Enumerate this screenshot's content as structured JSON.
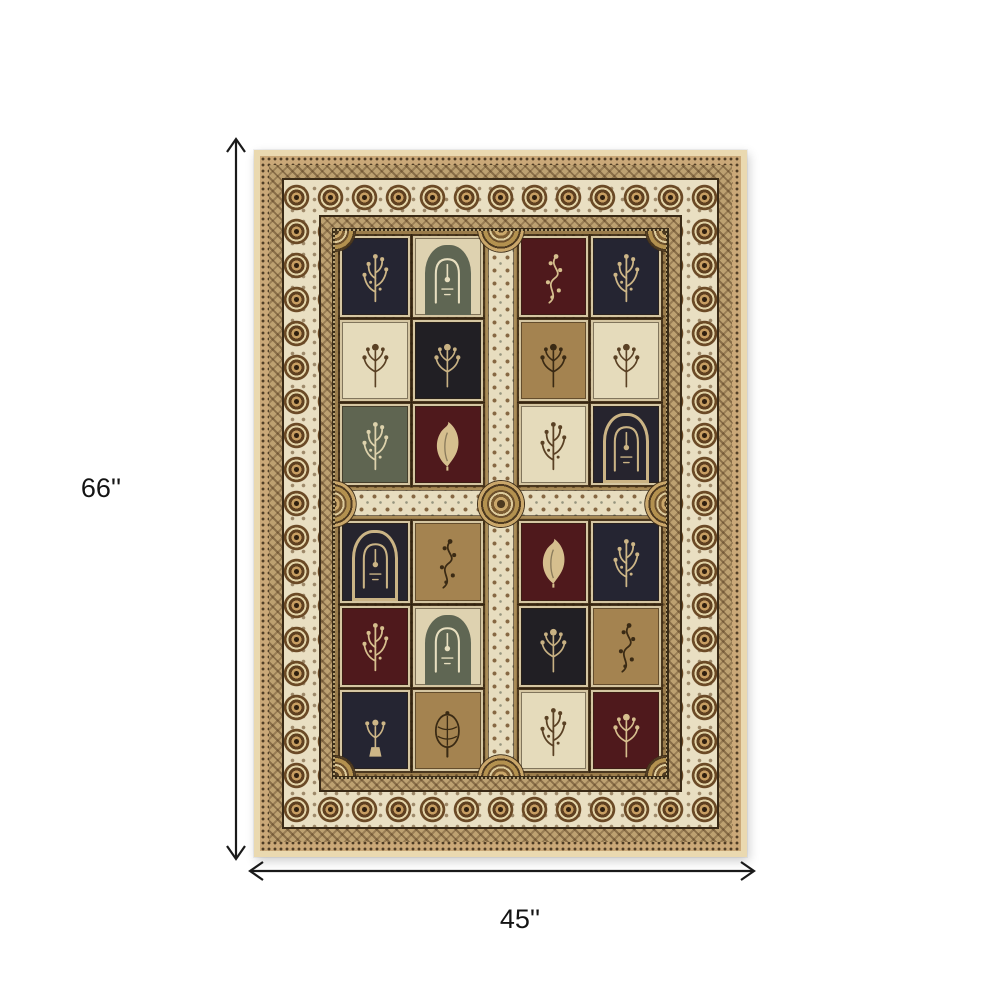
{
  "diagram": {
    "height_label": "66''",
    "width_label": "45''",
    "arrow_color": "#1a1a1a"
  },
  "rug": {
    "description": "Traditional ivory and brown panel-design area rug with garden-of-paradise motif panels and rosette border",
    "structure": {
      "binding": "#ead9b0",
      "guard_check": "#caa878",
      "guard_tan": "#bda171",
      "dark_line": "#3a2a16",
      "main_border": "#e9dfc2",
      "rosette": "#6b4a26",
      "field": "#9a7c4b",
      "strip": "#e7ddbf"
    },
    "palette": {
      "navy": {
        "bg": "#252532",
        "fg": "#cdb687"
      },
      "black": {
        "bg": "#211f24",
        "fg": "#c8b183"
      },
      "burgundy": {
        "bg": "#4f191c",
        "fg": "#d6bf8e"
      },
      "ivory": {
        "bg": "#e5dbbb",
        "fg": "#5a4124"
      },
      "tan": {
        "bg": "#a48350",
        "fg": "#3a2a14"
      },
      "olive": {
        "bg": "#5f6551",
        "fg": "#ddd2ac"
      },
      "arch_light": {
        "bg": "#ded2b0",
        "fg": "#e8dfc0",
        "arch": "#5f6653"
      },
      "arch_dark": {
        "bg": "#26242e",
        "fg": "#cbb485",
        "arch": "#cbb485"
      }
    },
    "panels": [
      {
        "color": "navy",
        "motif": "tree"
      },
      {
        "color": "arch_light",
        "motif": "arch"
      },
      {
        "color": "burgundy",
        "motif": "vine"
      },
      {
        "color": "navy",
        "motif": "tree"
      },
      {
        "color": "ivory",
        "motif": "floral"
      },
      {
        "color": "black",
        "motif": "floral"
      },
      {
        "color": "tan",
        "motif": "floral"
      },
      {
        "color": "ivory",
        "motif": "floral"
      },
      {
        "color": "olive",
        "motif": "tree"
      },
      {
        "color": "burgundy",
        "motif": "leaf"
      },
      {
        "color": "ivory",
        "motif": "tree"
      },
      {
        "color": "arch_dark",
        "motif": "arch"
      },
      {
        "color": "arch_dark",
        "motif": "arch"
      },
      {
        "color": "tan",
        "motif": "vine"
      },
      {
        "color": "burgundy",
        "motif": "leaf"
      },
      {
        "color": "navy",
        "motif": "tree"
      },
      {
        "color": "burgundy",
        "motif": "tree"
      },
      {
        "color": "arch_light",
        "motif": "arch"
      },
      {
        "color": "black",
        "motif": "floral"
      },
      {
        "color": "tan",
        "motif": "vine"
      },
      {
        "color": "navy",
        "motif": "vase"
      },
      {
        "color": "tan",
        "motif": "plant"
      },
      {
        "color": "ivory",
        "motif": "tree"
      },
      {
        "color": "burgundy",
        "motif": "floral"
      }
    ]
  }
}
